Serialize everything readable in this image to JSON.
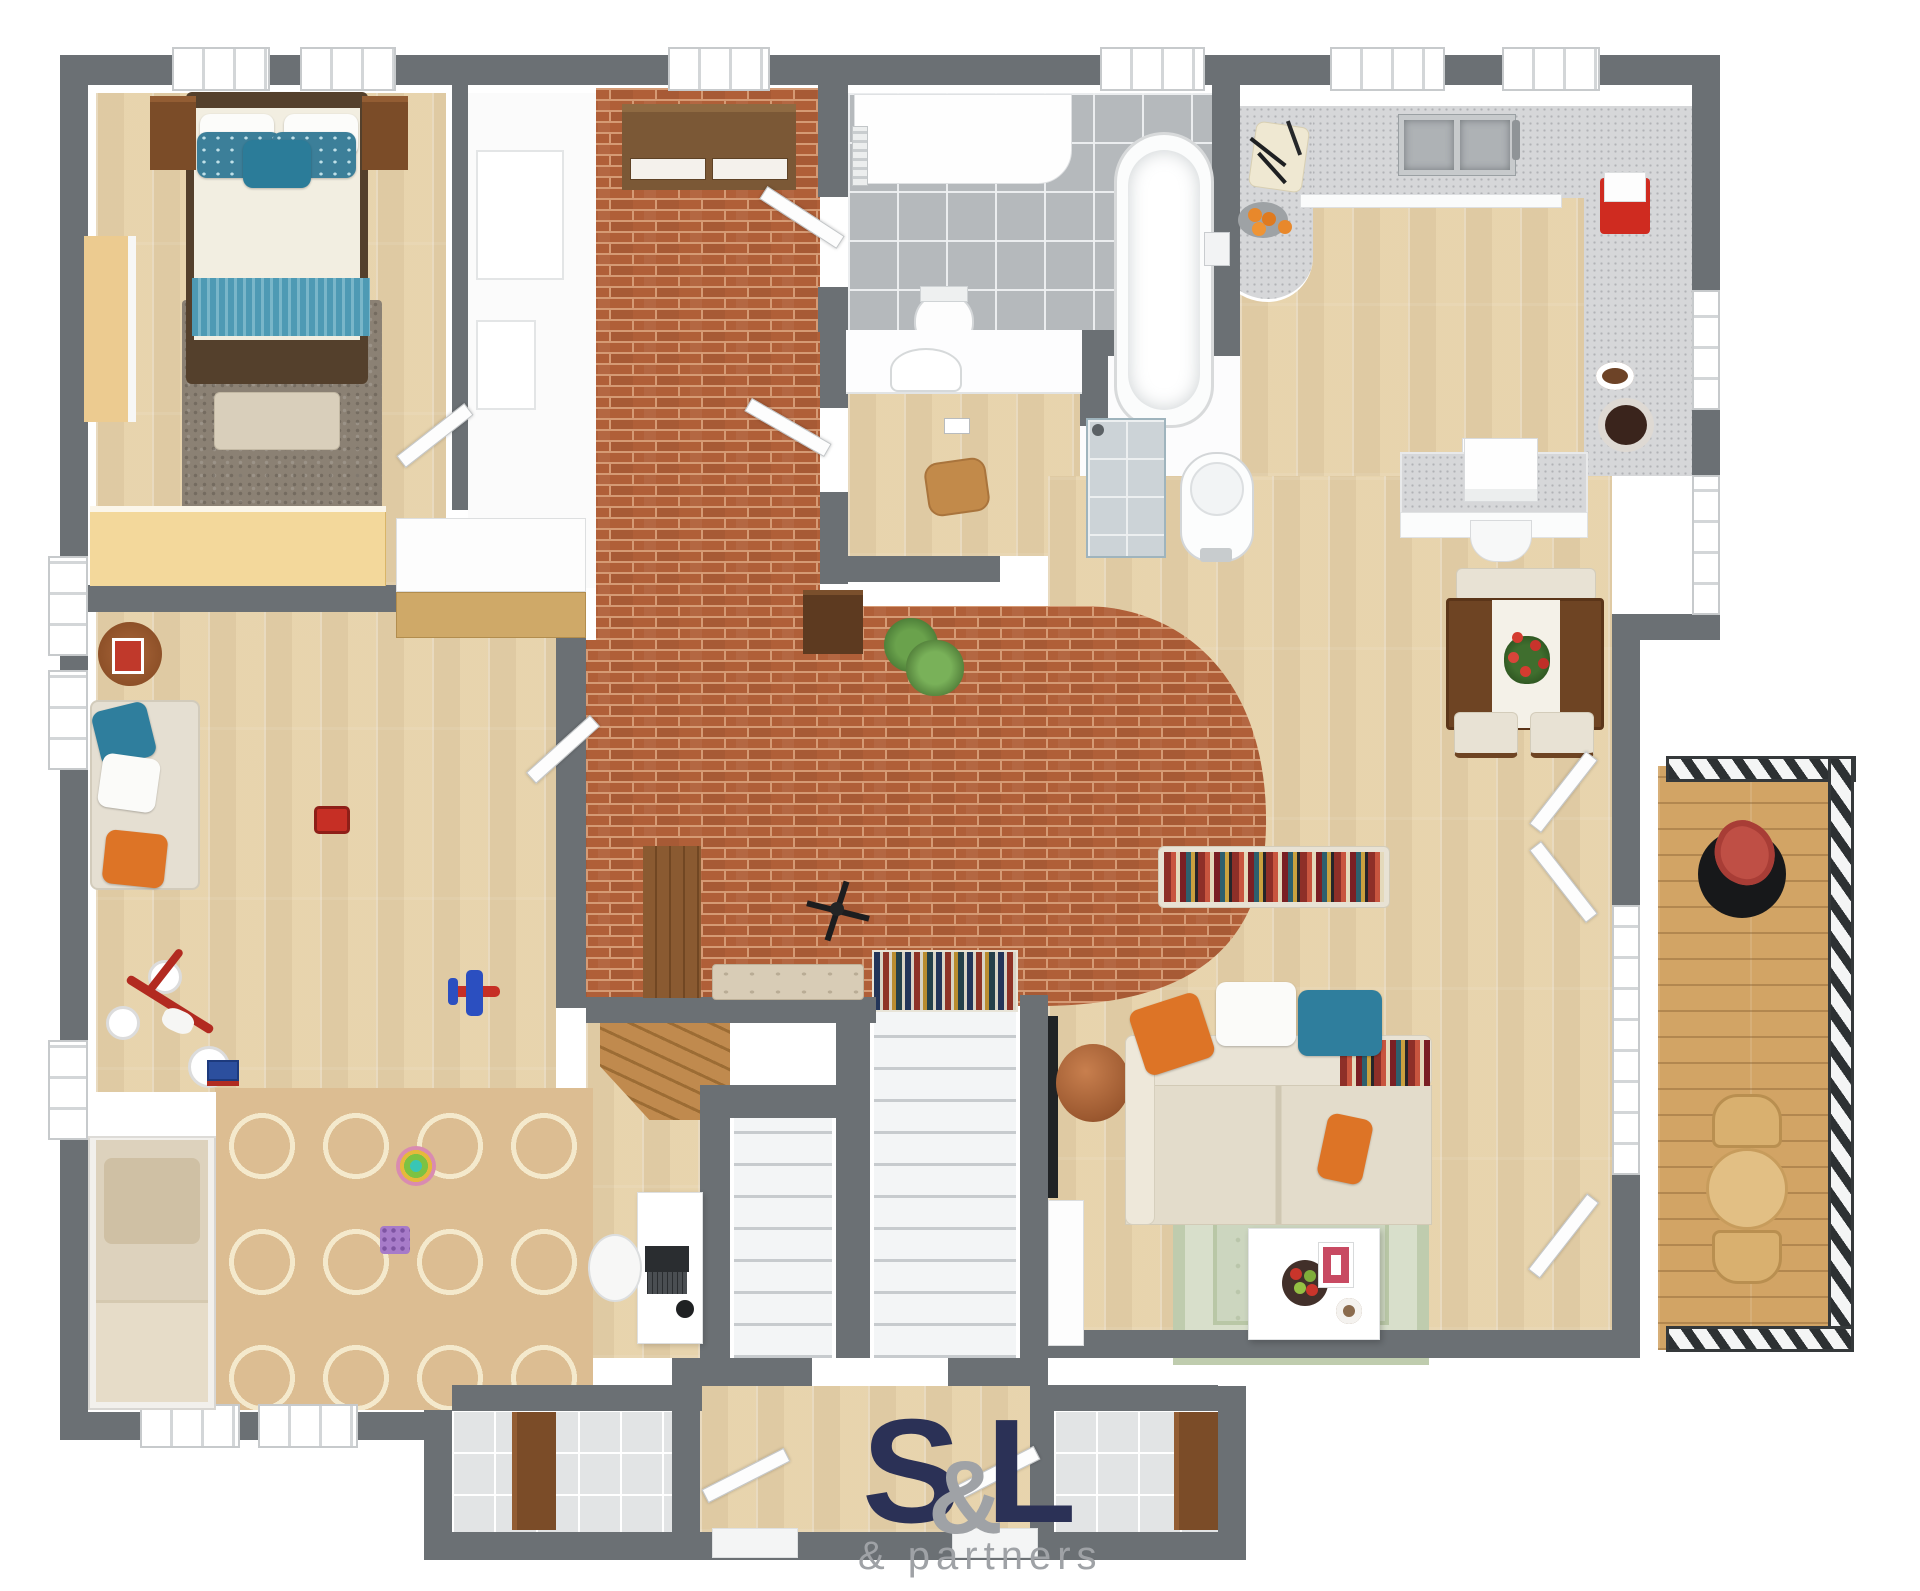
{
  "logo": {
    "s": "S",
    "amp": "&",
    "l": "L",
    "tagline": "& partners"
  },
  "brand_colors": {
    "navy": "#2b3156",
    "gray": "#9b9ea1"
  },
  "plan": {
    "type": "3d-floor-plan-render",
    "view": "top-down",
    "palette": {
      "wall": "#6b7074",
      "wood_floor": "#e9d7b2",
      "brick_floor": "#b05f38",
      "bathroom_tile": "#b5b9bc",
      "countertop": "#d6d7d9",
      "deck": "#d2a465",
      "accent_teal": "#2f7e9d",
      "accent_orange": "#dd7426",
      "rug_sage": "#ccd6bf",
      "rug_trellis": "#dcbd92"
    },
    "rooms": [
      {
        "id": "bedroom",
        "furniture": [
          "double-bed",
          "teal-pillows",
          "nightstands",
          "foot-bench",
          "shag-rug",
          "dresser",
          "sideboard",
          "wardrobe-unit"
        ]
      },
      {
        "id": "brick-hallway",
        "furniture": [
          "sideboard",
          "coat-cabinet",
          "coat-stand",
          "tufted-bench",
          "potted-plant",
          "wood-cabinet"
        ]
      },
      {
        "id": "bathroom",
        "furniture": [
          "vanity",
          "towel-rail",
          "toilet",
          "freestanding-bathtub",
          "wall-faucet"
        ]
      },
      {
        "id": "wc",
        "furniture": [
          "round-basin",
          "wooden-table",
          "toilet-paper-holder"
        ]
      },
      {
        "id": "utility",
        "furniture": [
          "shower-stall",
          "washing-machine"
        ]
      },
      {
        "id": "kitchen",
        "furniture": [
          "l-shaped-counter",
          "curved-peninsula",
          "double-sink",
          "cutting-board-with-knives",
          "orange-fruit-bowl",
          "red-appliance",
          "chocolate-plate",
          "serving-bowl",
          "lower-shelf"
        ]
      },
      {
        "id": "dining-area",
        "furniture": [
          "desk-with-printer",
          "desk-chair",
          "dining-table",
          "white-runner",
          "red-flower-centerpiece",
          "dining-bench",
          "dining-chairs"
        ]
      },
      {
        "id": "living-room",
        "furniture": [
          "striped-chaise",
          "sectional-sofa",
          "orange-pillows",
          "white-pillow",
          "teal-pillows",
          "striped-throw",
          "leather-pouf",
          "coffee-table",
          "apple-bowl",
          "magazine",
          "small-dish",
          "wall-tv",
          "media-console",
          "sage-rug"
        ]
      },
      {
        "id": "playroom",
        "furniture": [
          "sofa",
          "round-side-table",
          "magazine",
          "daybed",
          "trellis-rug",
          "tricycle",
          "toy-plane",
          "toy-car",
          "stacking-rings",
          "toy-easel",
          "toy-blocks",
          "desk",
          "laptop",
          "desk-lamp",
          "desk-chair"
        ]
      },
      {
        "id": "staircase",
        "furniture": [
          "wide-flight",
          "return-flight",
          "striped-runner",
          "wooden-winder-steps"
        ]
      },
      {
        "id": "entry",
        "furniture": [
          "left-storage-room",
          "right-storage-room",
          "storage-cabinets",
          "entry-doors"
        ]
      },
      {
        "id": "balcony",
        "furniture": [
          "round-bistro-table",
          "deck-chairs",
          "black-planter-with-red-plant",
          "railing"
        ]
      }
    ]
  }
}
